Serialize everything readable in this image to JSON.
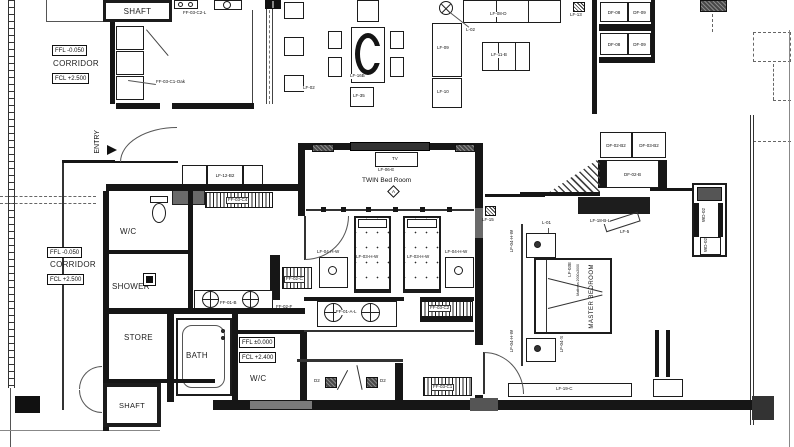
{
  "rooms": {
    "shaft": "SHAFT",
    "corridor": "CORRIDOR",
    "entry": "ENTRY",
    "wc": "W/C",
    "shower": "SHOWER",
    "store": "STORE",
    "bath": "BATH",
    "twin_bedroom": "TWIN Bed Room",
    "master_bedroom": "MASTER BEDROOM"
  },
  "levels": {
    "ffl_minus": "FFL -0.050",
    "fcl_2500": "FCL +2.500",
    "ffl_zero": "FFL ±0.000",
    "fcl_2400": "FCL +2.400"
  },
  "tags": {
    "lf_02": "LF-02",
    "lf_16b": "LF-16B",
    "lf_35": "LF-35",
    "l_02": "L-02",
    "lf_08_d": "LF-08-D",
    "lf_09": "LF-09",
    "lf_10": "LF-10",
    "lf_11_b": "LF-11-B",
    "lf_13": "LF-13",
    "lf_15": "LF-15",
    "lf_12_b2": "LF-12-B2",
    "lf_06_e": "LF-06-E",
    "tv": "TV",
    "lf_03_h_w": "LF-03-H-W",
    "lf_04_h_w": "LF-04-H-W",
    "lf_03e": "LF-03E",
    "mattress": "Mattress 2000x2000",
    "l_01": "L-01",
    "lf_04_s": "LF-04-S",
    "lf_19_c": "LF-19-C",
    "lf_18_b_l": "LF-18-B-L",
    "lf_5": "LF-5",
    "wd_02": "WD-02",
    "df_08": "DF-08",
    "df_09": "DF-09",
    "df_02_b2": "DF-02-B2",
    "df_03_b2": "DF-03-B2",
    "df_02_b": "DF-02-B",
    "ff_03_c1_oak": "FF-03-C1-Oak",
    "ff_03_c2_l": "FF-03-C2-L",
    "ff_03_c4": "FF-03-C4",
    "ff_03_c2": "FF-03-C2",
    "ff_03_c1": "FF-03-C1",
    "ff_02_c": "FF-02-C",
    "ff_02_f": "FF-02-F",
    "ff_01_b": "FF-01-B",
    "ff_01_a_l": "FF-01-A-L",
    "d2": "D2",
    "section_a": "A"
  }
}
